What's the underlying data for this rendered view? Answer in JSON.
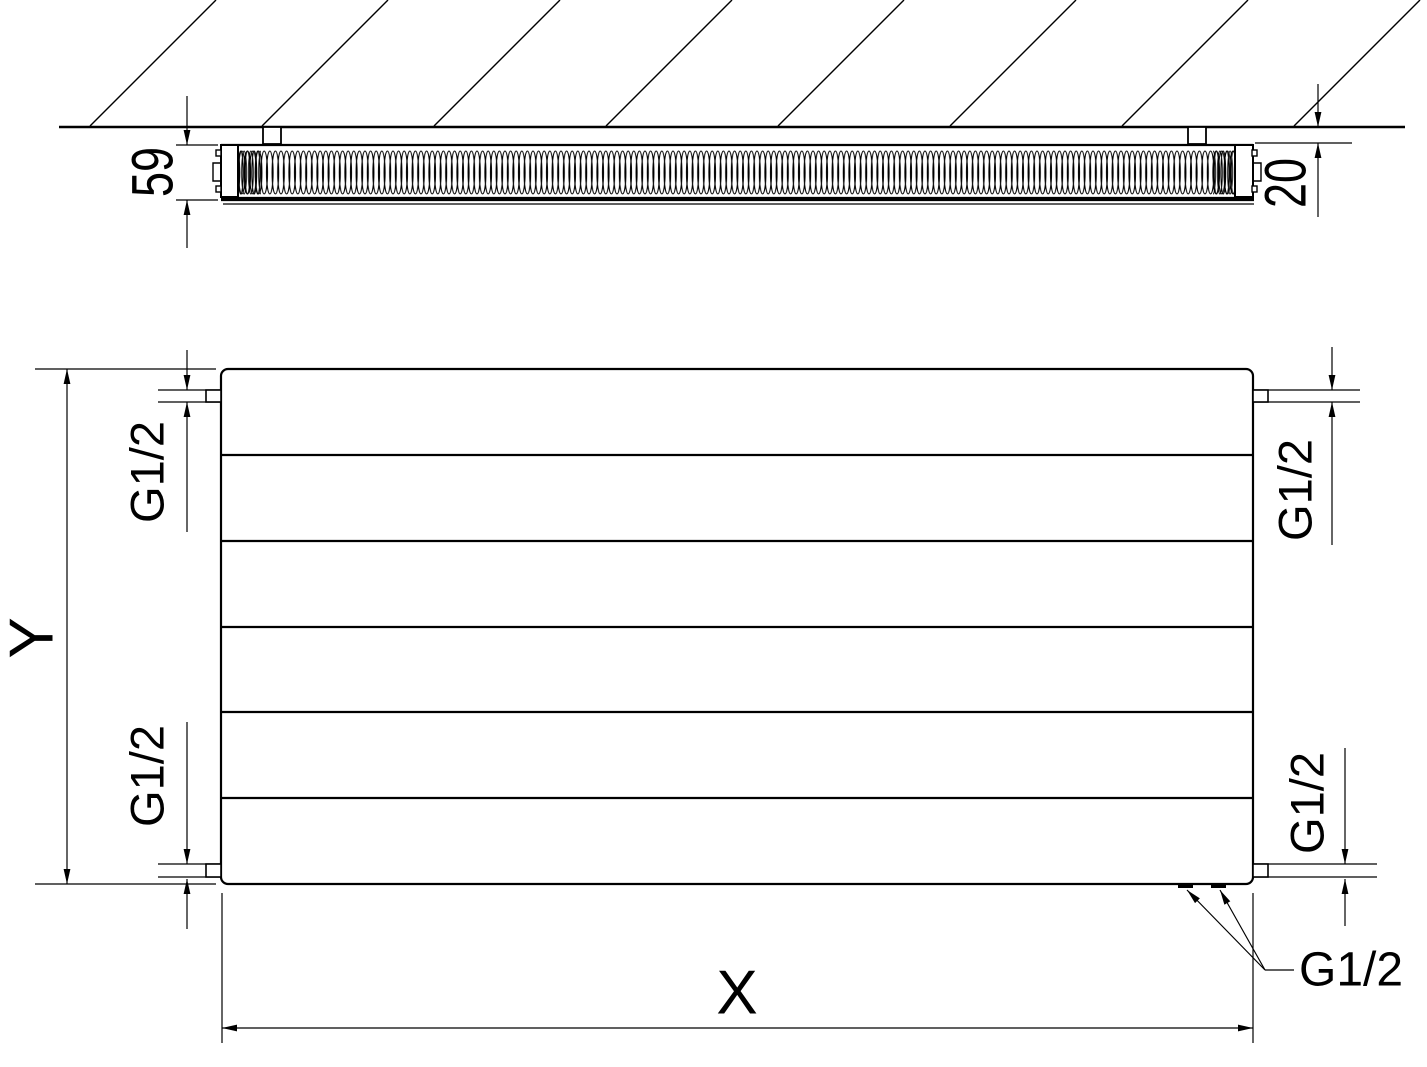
{
  "drawing": {
    "side_view": {
      "depth": "59",
      "wall_distance": "20"
    },
    "front_view": {
      "height": "Y",
      "width": "X",
      "thread_top_left": "G1/2",
      "thread_top_right": "G1/2",
      "thread_bottom_left": "G1/2",
      "thread_bottom_right": "G1/2",
      "thread_bottom_connections": "G1/2"
    },
    "colors": {
      "line": "#000000",
      "background": "#ffffff"
    }
  }
}
